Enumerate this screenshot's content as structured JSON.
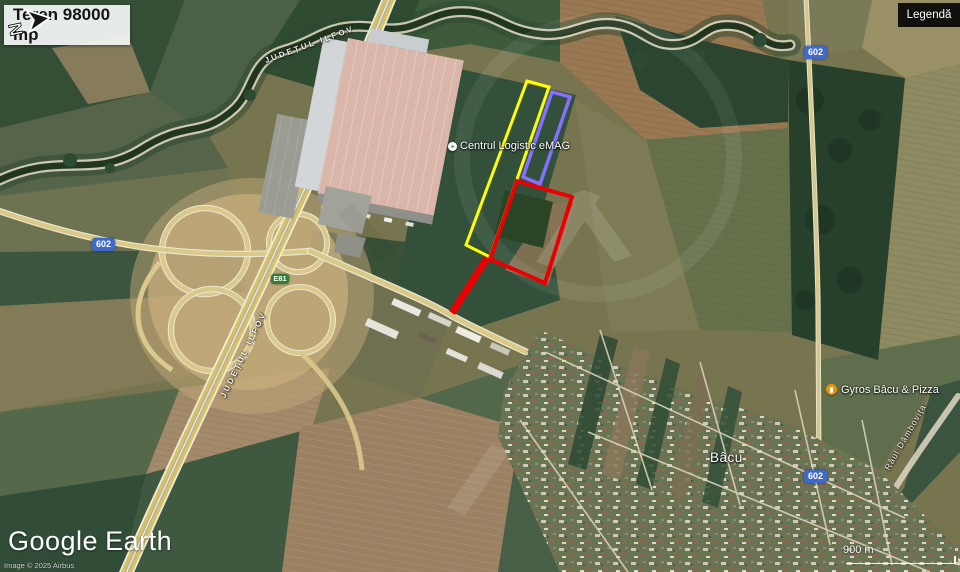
{
  "overlay": {
    "area_label": "Teren 98000 mp",
    "legend_button": "Legendă"
  },
  "map_labels": {
    "logistics_center": "Centrul Logistic eMAG",
    "town": "Bâcu",
    "poi": "Gyros Bâcu & Pizza",
    "county_boundary": "JUDEȚUL ILFOV",
    "river": "Râul Dâmbovița"
  },
  "road_shields": {
    "dj602": "602",
    "e81": "E81"
  },
  "parcels": {
    "yellow": {
      "points": "527,81 549,87 490,257 466,245",
      "color": "#ffff00"
    },
    "purple": {
      "points": "552,92 570,97 540,184 523,177",
      "color": "#8470ff"
    },
    "red": {
      "points": "517,181 572,197 545,283 490,259",
      "color": "#ea0000"
    },
    "red_access_strip": {
      "points": "487,258 452,313",
      "color": "#ea0000"
    }
  },
  "footer": {
    "logo_primary": "Google",
    "logo_secondary": "Earth",
    "attribution": "Image © 2025 Airbus",
    "scale_label": "900 m",
    "compass_north": "N"
  },
  "colors": {
    "poi_orange": "#ef9400",
    "shield_blue": "#4169c8",
    "shield_green": "#2f7d36"
  }
}
